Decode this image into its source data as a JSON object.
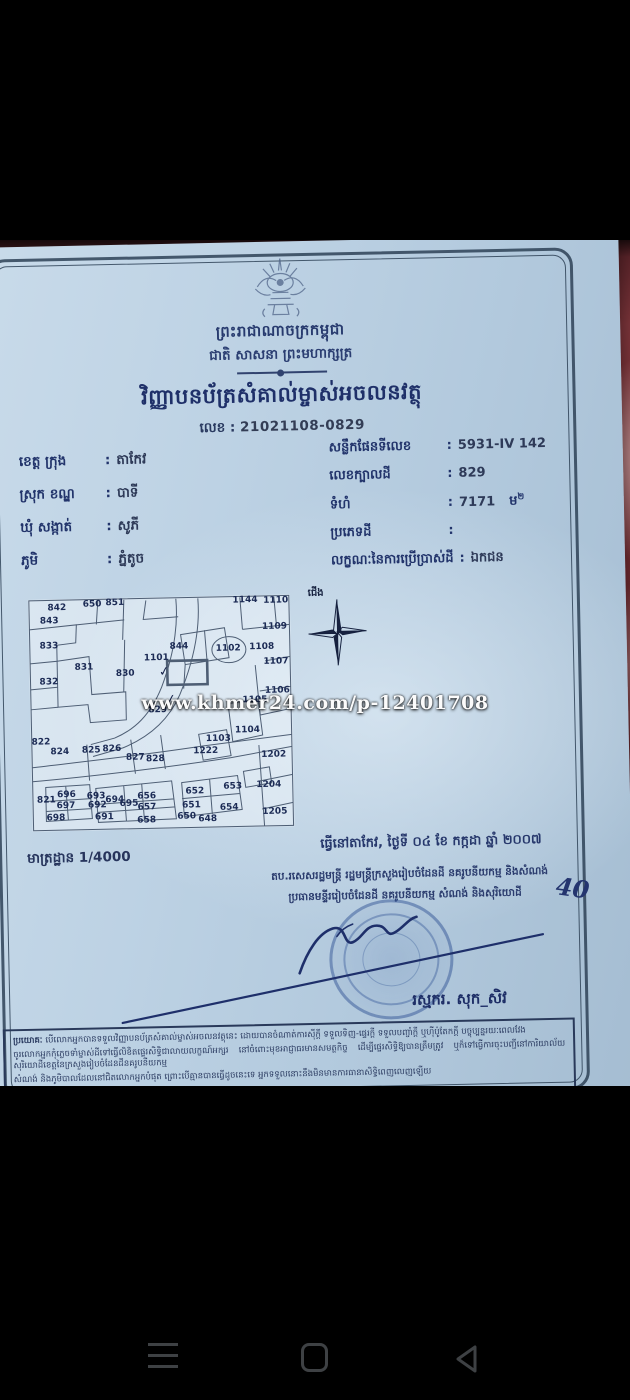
{
  "colors": {
    "paper": "#bdd2e4",
    "ink": "#22346b",
    "stamp_blue": "#3a5ea0",
    "background_fabric": "#7c3036",
    "nav_icon": "#3e4144"
  },
  "watermark": "www.khmer24.com/p-12401708",
  "document": {
    "kingdom_line": "ព្រះរាជាណាចក្រកម្ពុជា",
    "motto_line": "ជាតិ សាសនា ព្រះមហាក្សត្រ",
    "title": "វិញ្ញាបនប័ត្រសំគាល់ម្ចាស់អចលនវត្ថុ",
    "doc_number_label": "លេខ :",
    "doc_number": "21021108-0829",
    "field_separator": ":",
    "location_fields": [
      {
        "label": "ខេត្ត ក្រុង",
        "value": "តាកែវ"
      },
      {
        "label": "ស្រុក ខណ្ឌ",
        "value": "បាទី"
      },
      {
        "label": "ឃុំ សង្កាត់",
        "value": "សូភី"
      },
      {
        "label": "ភូមិ",
        "value": "ភ្នំតូច"
      }
    ],
    "parcel_fields": [
      {
        "label": "សន្លឹកផែនទីលេខ",
        "value": "5931-IV 142"
      },
      {
        "label": "លេខក្បាលដី",
        "value": "829"
      },
      {
        "label": "ទំហំ",
        "value": "7171",
        "unit": "ម",
        "unit_sup": "២"
      },
      {
        "label": "ប្រភេទដី",
        "value": ""
      },
      {
        "label": "លក្ខណៈនៃការប្រើប្រាស់ដី",
        "value": "ឯកជន"
      }
    ],
    "compass_label": "ជើង",
    "map": {
      "highlighted_parcel": "829",
      "checkmark_symbol": "✓",
      "checkmarks": [
        {
          "x": 51.5,
          "y": 32.3
        },
        {
          "x": 53.8,
          "y": 44.4
        }
      ],
      "parcels": [
        {
          "n": "842",
          "x": 11.0,
          "y": 3.9
        },
        {
          "n": "650",
          "x": 24.5,
          "y": 2.5
        },
        {
          "n": "851",
          "x": 33.2,
          "y": 2.2
        },
        {
          "n": "843",
          "x": 8.0,
          "y": 9.4
        },
        {
          "n": "833",
          "x": 7.7,
          "y": 20.1
        },
        {
          "n": "831",
          "x": 20.9,
          "y": 29.9
        },
        {
          "n": "832",
          "x": 7.4,
          "y": 35.6
        },
        {
          "n": "844",
          "x": 57.3,
          "y": 21.6
        },
        {
          "n": "1101",
          "x": 48.6,
          "y": 26.2
        },
        {
          "n": "830",
          "x": 36.6,
          "y": 32.8
        },
        {
          "n": "1102",
          "x": 76.1,
          "y": 22.7
        },
        {
          "n": "1108",
          "x": 88.9,
          "y": 22.6
        },
        {
          "n": "1144",
          "x": 82.9,
          "y": 2.0
        },
        {
          "n": "1110",
          "x": 94.6,
          "y": 2.4
        },
        {
          "n": "1109",
          "x": 93.9,
          "y": 13.7
        },
        {
          "n": "1107",
          "x": 94.2,
          "y": 28.7
        },
        {
          "n": "1106",
          "x": 94.5,
          "y": 41.4
        },
        {
          "n": "1105",
          "x": 85.9,
          "y": 45.1
        },
        {
          "n": "829",
          "x": 48.7,
          "y": 48.9
        },
        {
          "n": "822",
          "x": 3.9,
          "y": 61.8
        },
        {
          "n": "824",
          "x": 11.0,
          "y": 65.8
        },
        {
          "n": "825",
          "x": 23.0,
          "y": 65.4
        },
        {
          "n": "826",
          "x": 30.9,
          "y": 65.0
        },
        {
          "n": "827",
          "x": 39.8,
          "y": 69.0
        },
        {
          "n": "828",
          "x": 47.4,
          "y": 70.0
        },
        {
          "n": "1103",
          "x": 71.6,
          "y": 61.5
        },
        {
          "n": "1222",
          "x": 66.7,
          "y": 66.8
        },
        {
          "n": "1104",
          "x": 82.8,
          "y": 58.2
        },
        {
          "n": "1202",
          "x": 92.6,
          "y": 69.0
        },
        {
          "n": "696",
          "x": 13.2,
          "y": 84.5
        },
        {
          "n": "697",
          "x": 12.9,
          "y": 89.1
        },
        {
          "n": "693",
          "x": 24.5,
          "y": 85.2
        },
        {
          "n": "692",
          "x": 24.9,
          "y": 89.4
        },
        {
          "n": "694",
          "x": 31.6,
          "y": 87.0
        },
        {
          "n": "695",
          "x": 37.0,
          "y": 88.8
        },
        {
          "n": "656",
          "x": 43.8,
          "y": 85.6
        },
        {
          "n": "657",
          "x": 43.8,
          "y": 90.5
        },
        {
          "n": "652",
          "x": 62.2,
          "y": 84.1
        },
        {
          "n": "653",
          "x": 76.7,
          "y": 82.2
        },
        {
          "n": "651",
          "x": 60.8,
          "y": 90.1
        },
        {
          "n": "654",
          "x": 75.2,
          "y": 91.5
        },
        {
          "n": "1204",
          "x": 90.5,
          "y": 81.9
        },
        {
          "n": "821",
          "x": 5.5,
          "y": 86.6
        },
        {
          "n": "698",
          "x": 9.0,
          "y": 94.5
        },
        {
          "n": "691",
          "x": 27.5,
          "y": 94.5
        },
        {
          "n": "658",
          "x": 43.6,
          "y": 96.2
        },
        {
          "n": "650",
          "x": 58.9,
          "y": 94.8
        },
        {
          "n": "648",
          "x": 66.9,
          "y": 96.2
        },
        {
          "n": "1205",
          "x": 92.6,
          "y": 93.7
        }
      ]
    },
    "scale_label": "មាត្រដ្ឋាន 1/4000",
    "issued": {
      "place_date": "ធ្វើនៅតាកែវ, ថ្ងៃទី ០៤ ខែ កក្កដា ឆ្នាំ ២០០៧",
      "authority_line1": "តប.រសេសរដ្ឋមន្ត្រី រដ្ឋមន្ត្រីក្រសួងរៀបចំដែនដី នគរូបនីយកម្ម និងសំណង់",
      "authority_line2": "ប្រធានមន្ទីររៀបចំដែនដី នគរូបនីយកម្ម សំណង់ និងសុរិយោដី",
      "handwritten_note": "40",
      "signer_name": "រស្មករ. សុក_សិវ"
    },
    "footer": {
      "intro": "ប្រយោគៈ",
      "lines": [
        "បើលោកអ្នកបានទទួលវិញ្ញាបនប័ត្រសំគាល់ម្ចាស់អចលនវត្ថុនេះ ដោយបានចំណាត់ការស៊ីក្តី ទទួលទិញ-ផ្ទេរក្តី ទទួលបញ្ចាំក្តី ឬហ៊ីប៉ូតែកក្តី បច្ចុប្បន្នរយៈពេលវែង",
        "ចូរលោកអ្នកកុំភ្លេចទាំម្ចាស់ដីទៅធ្វើលិខិតផ្ទេរសិទ្ធិជាលាយលក្ខណ៍អក្សរ នៅចំពោះមុខអាជ្ញាធរមានសមត្ថកិច្ច ដើម្បីផ្ទេរសិទ្ធិឱ្យបានត្រឹមត្រូវ ឬក៏ទៅធ្វើការចុះបញ្ជីនៅការិយាល័យសុរិយោដីខេត្តនៃក្រសួងរៀបចំដែនដីនគរូបនីយកម្ម",
        "សំណង់ និងភូមិបាលដែលនៅជិតលោកអ្នកបំផុត ព្រោះបើគ្មានបានធ្វើដូចនេះទេ អ្នកទទួលនោះនឹងមិនមានការធានាសិទ្ធិពេញលេញឡើយ"
      ]
    }
  },
  "nav": {
    "menu_icon": "hamburger-menu",
    "home_icon": "home-square",
    "back_icon": "back-triangle"
  }
}
